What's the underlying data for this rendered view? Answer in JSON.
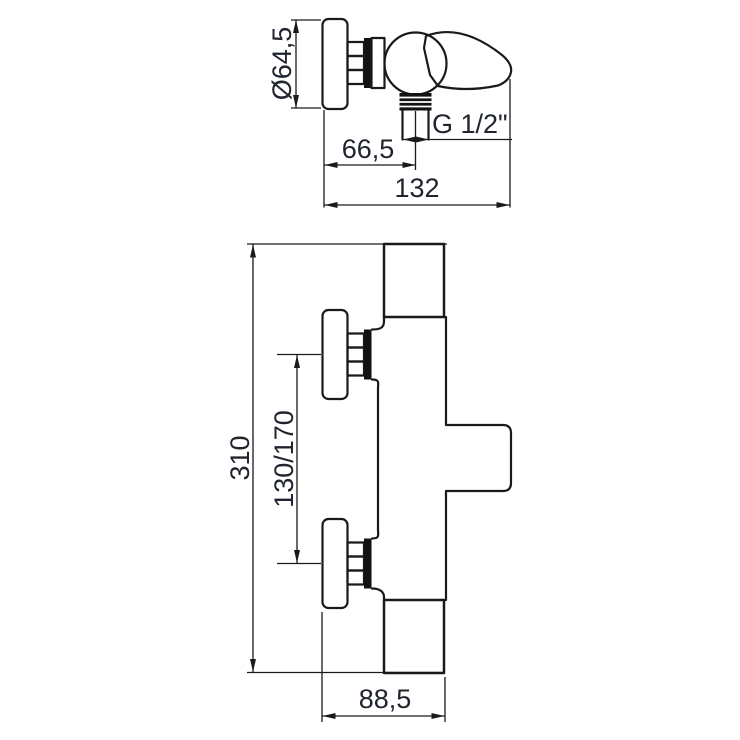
{
  "side_view": {
    "diameter_label": "Ø64,5",
    "offset_label": "66,5",
    "depth_label": "132",
    "thread_label": "G 1/2\""
  },
  "front_view": {
    "height_label": "310",
    "spacing_label": "130/170",
    "projection_label": "88,5"
  },
  "colors": {
    "line": "#1a1a1a",
    "solid_fill": "#121212",
    "text": "#20242e",
    "background": "#ffffff"
  }
}
